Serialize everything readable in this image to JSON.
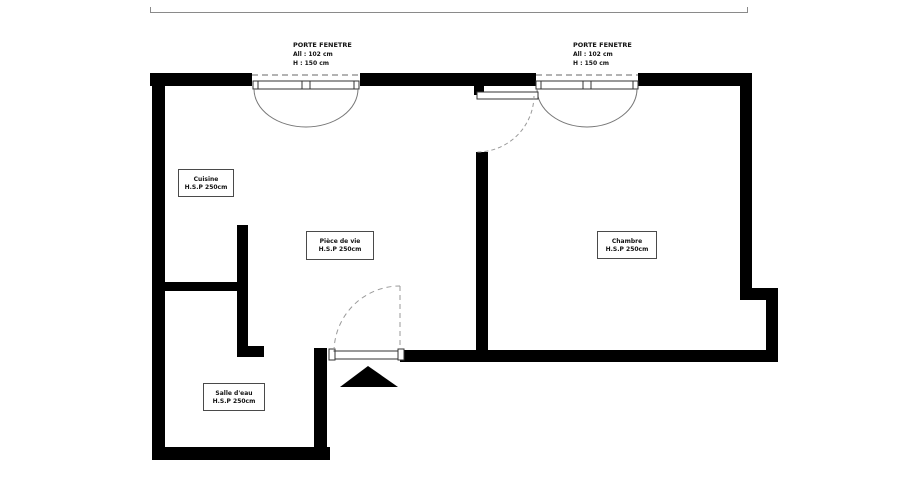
{
  "plan": {
    "title": "Floor plan",
    "windows": [
      {
        "title": "PORTE FENETRE",
        "sill": "All : 102 cm",
        "height": "H : 150 cm"
      },
      {
        "title": "PORTE FENETRE",
        "sill": "All : 102 cm",
        "height": "H : 150 cm"
      }
    ],
    "rooms": [
      {
        "name": "Cuisine",
        "ceiling": "H.S.P 250cm"
      },
      {
        "name": "Pièce de vie",
        "ceiling": "H.S.P 250cm"
      },
      {
        "name": "Chambre",
        "ceiling": "H.S.P 250cm"
      },
      {
        "name": "Salle d'eau",
        "ceiling": "H.S.P 250cm"
      }
    ],
    "colors": {
      "wall": "#000000",
      "background": "#ffffff",
      "thin_line": "#8a8a8a",
      "swing_line": "#9a9a9a"
    }
  }
}
